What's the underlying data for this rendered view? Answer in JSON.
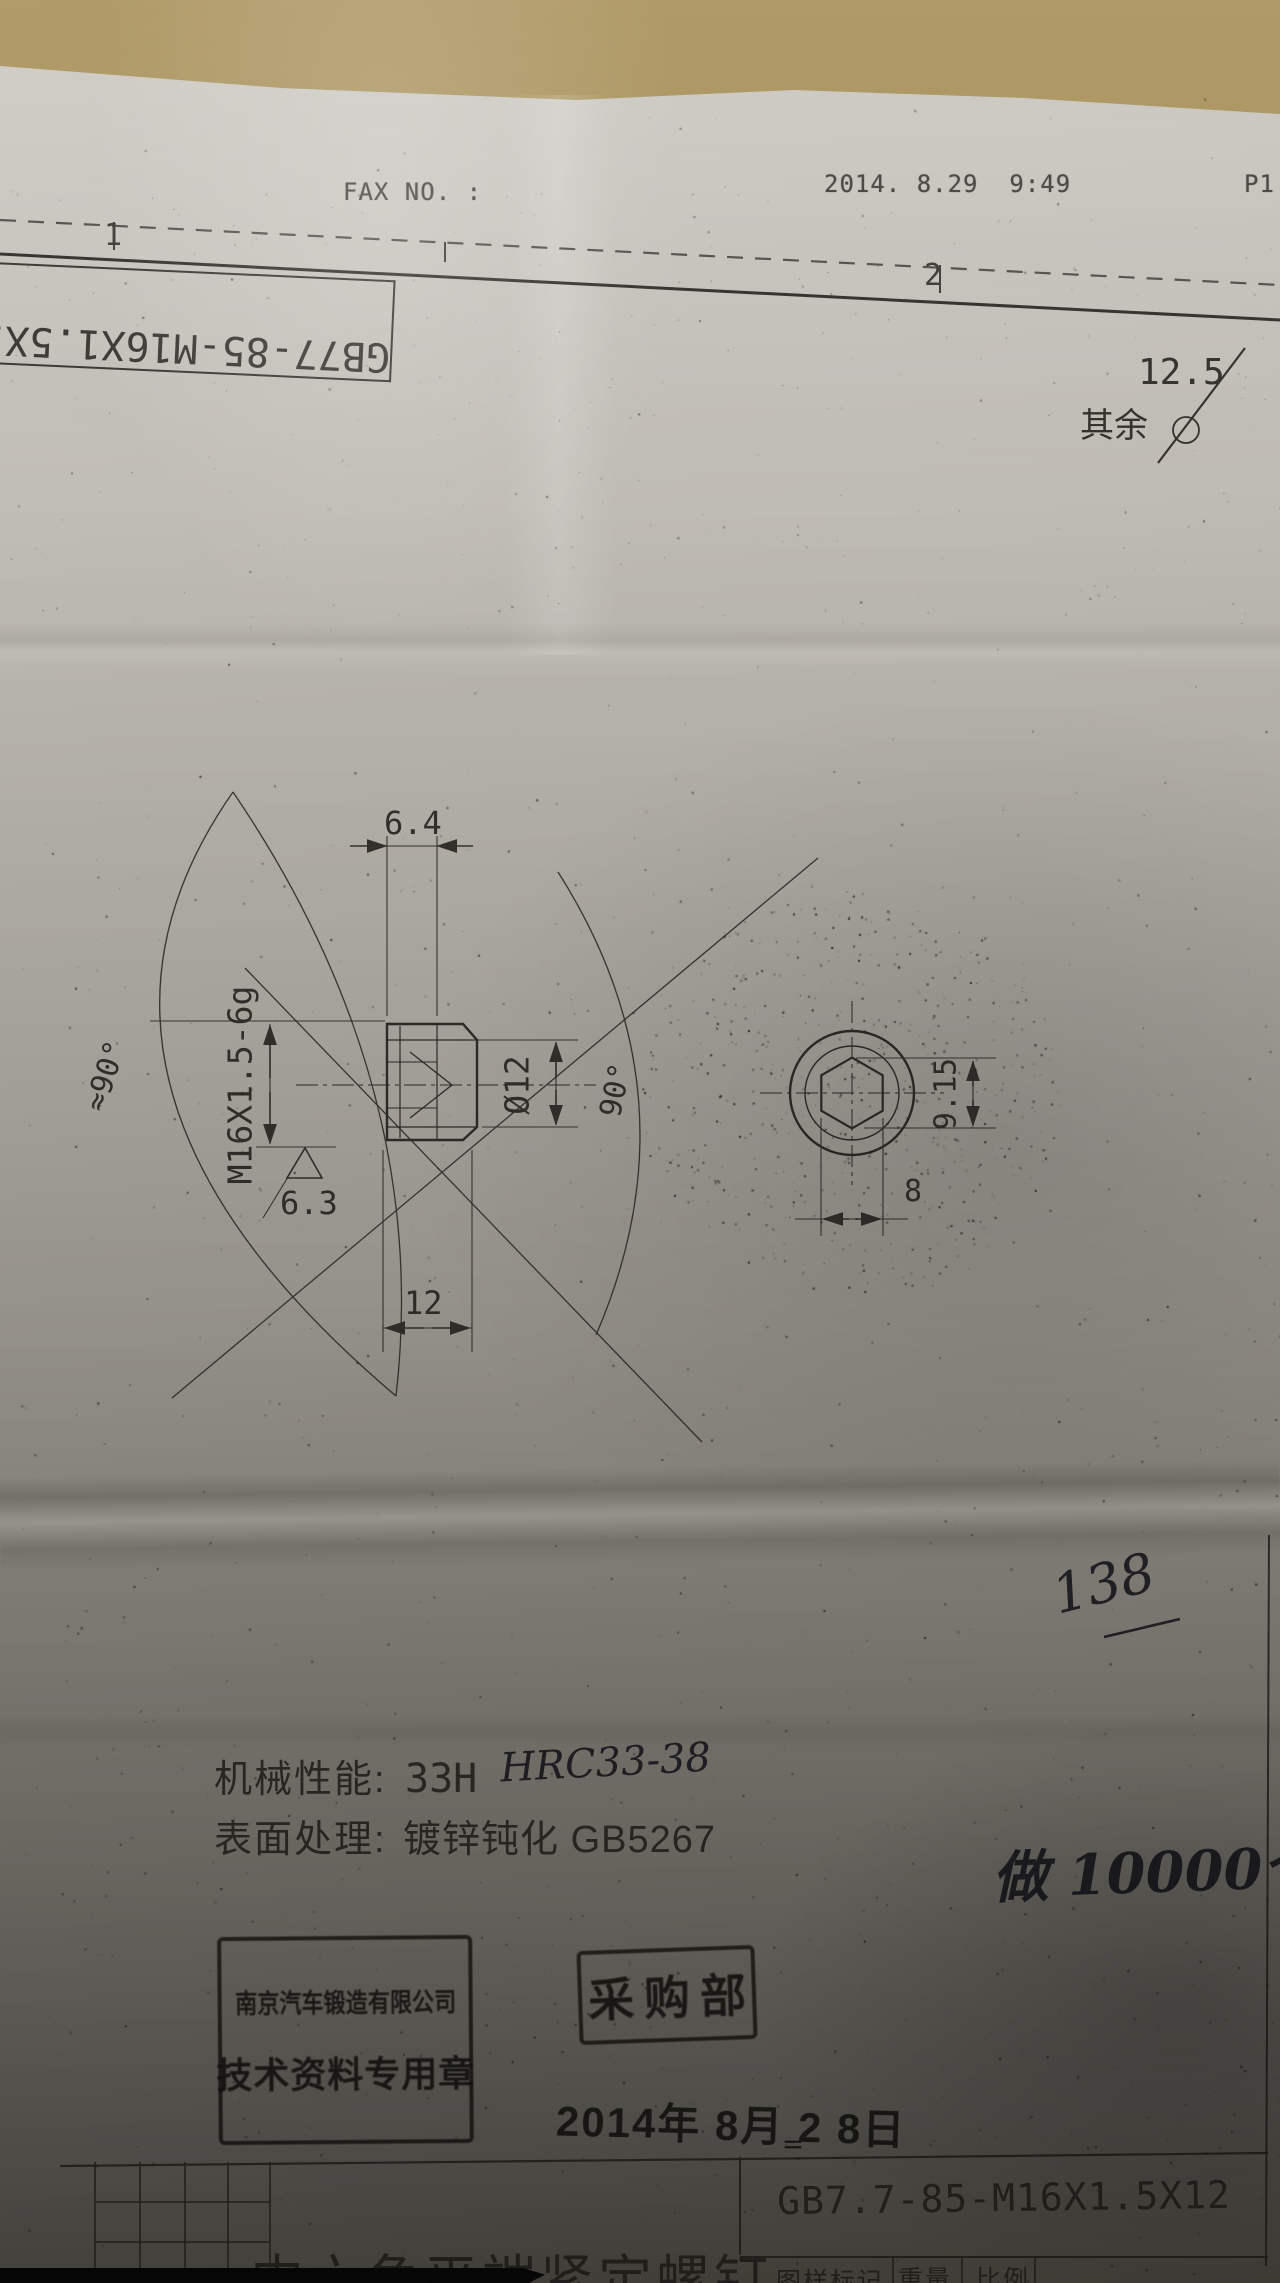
{
  "colors": {
    "table_background": "#a18a57",
    "paper": "#b8b5ad",
    "ink": "#33312c",
    "stamp_ink": "#181714"
  },
  "fax_header": {
    "label": "FAX NO. :",
    "datetime": "2014. 8.29  9:49",
    "page": "P1"
  },
  "ruler": {
    "mark1": "1",
    "mark2": "2"
  },
  "flipped_label": {
    "text": "GB77-85-M16X1.5X12"
  },
  "surface_note": {
    "prefix": "其余",
    "roughness": "12.5"
  },
  "drawing": {
    "dimensions": {
      "socket_width_top": "6.4",
      "thread": "M16X1.5-6g",
      "point_diameter": "Ø12",
      "roughness": "6.3",
      "length": "12",
      "angle_left": "≈90°",
      "angle_right": "90°",
      "across_corners": "9.15",
      "across_flats": "8"
    }
  },
  "notes": {
    "line1_label": "机械性能:",
    "line1_value": "33H",
    "line2_label": "表面处理:",
    "line2_value": "镀锌钝化 GB5267"
  },
  "handwriting": {
    "hardness": "HRC33-38",
    "number": "138",
    "quantity": "做 10000个"
  },
  "stamps": {
    "company_line1": "南京汽车锻造有限公司",
    "company_line2": "技术资料专用章",
    "department": "采购部",
    "date": "2014年 8月 2 8日",
    "date_mark": "＝"
  },
  "title_block": {
    "part_name": "内六角平端紧定螺钉",
    "designation": "GB7.7-85-M16X1.5X12",
    "header_mark": "图样标记",
    "header_weight": "重量",
    "header_scale": "比例"
  }
}
